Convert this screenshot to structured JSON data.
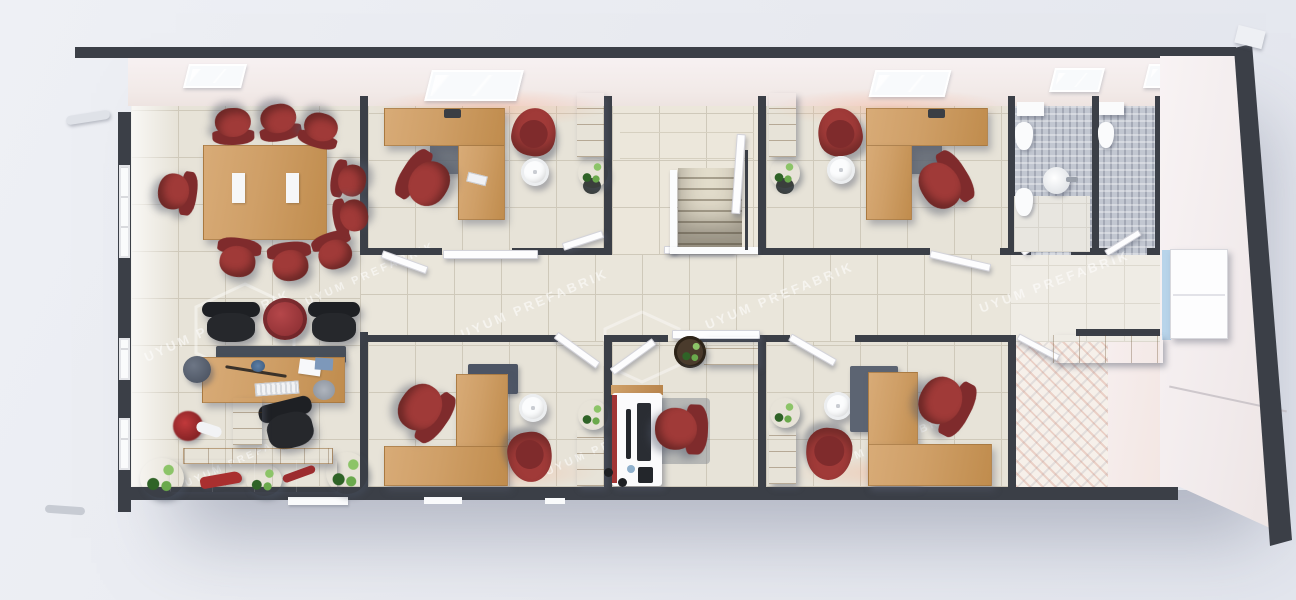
{
  "watermark": {
    "text": "UYUM PREFABRIK"
  },
  "palette": {
    "bg": "#e9ebf1",
    "wall-dark": "#3b3f47",
    "floor-tile": "#e7e3d8",
    "floor-line": "#cfc9ba",
    "corridor-tile": "#eae6db",
    "stair-tile": "#ece7db",
    "mosaic": "#c2c7d1",
    "pattern-floor": "#f6f0ea",
    "wood": "#cf9f67",
    "chair-red": "#a03a38",
    "chair-red-dark": "#7f2b2c",
    "chair-black": "#26282c",
    "slate": "#59616e",
    "plant": "#4f8f3d",
    "window-blue": "#aac8e6"
  }
}
